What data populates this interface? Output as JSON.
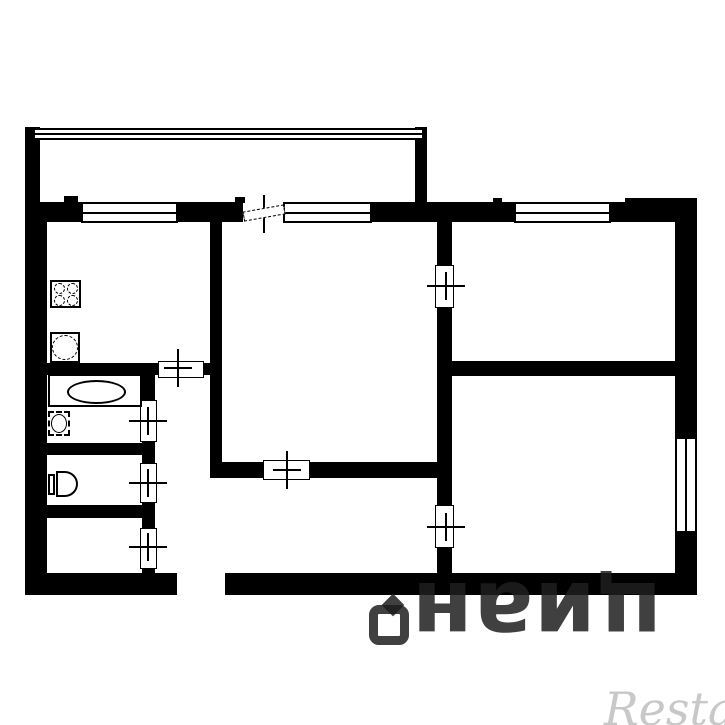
{
  "meta": {
    "background_color": "#ffffff",
    "wall_color": "#000000",
    "drawing_type": "apartment-floor-plan"
  },
  "watermarks": {
    "cian": {
      "text": "циан",
      "color": "rgba(30,30,30,0.85)",
      "rotation_deg": 180,
      "x": 412,
      "y": 540,
      "width": 250,
      "height": 105,
      "font_size": 88
    },
    "restate": {
      "text": "Restate",
      "color": "#c8c8c8",
      "x": 604,
      "y": 682,
      "font_size": 46
    }
  },
  "plan": {
    "walls": [
      {
        "name": "balcony-left-wall",
        "x": 25,
        "y": 127,
        "w": 15,
        "h": 76
      },
      {
        "name": "balcony-right-wall",
        "x": 415,
        "y": 127,
        "w": 12,
        "h": 78
      },
      {
        "name": "top-wall-left",
        "x": 25,
        "y": 202,
        "w": 56,
        "h": 20
      },
      {
        "name": "top-wall-mid-a",
        "x": 178,
        "y": 202,
        "w": 65,
        "h": 20
      },
      {
        "name": "top-wall-mid-b",
        "x": 372,
        "y": 202,
        "w": 142,
        "h": 20
      },
      {
        "name": "top-wall-right",
        "x": 611,
        "y": 202,
        "w": 86,
        "h": 20
      },
      {
        "name": "left-outer-wall",
        "x": 25,
        "y": 202,
        "w": 22,
        "h": 393
      },
      {
        "name": "right-outer-wall-upper",
        "x": 675,
        "y": 202,
        "w": 22,
        "h": 235
      },
      {
        "name": "right-outer-wall-lower",
        "x": 675,
        "y": 533,
        "w": 22,
        "h": 62
      },
      {
        "name": "bottom-wall-left",
        "x": 25,
        "y": 573,
        "w": 152,
        "h": 22
      },
      {
        "name": "bottom-wall-right",
        "x": 225,
        "y": 573,
        "w": 472,
        "h": 22
      },
      {
        "name": "livingroom-left-wall",
        "x": 210,
        "y": 222,
        "w": 12,
        "h": 256
      },
      {
        "name": "kitchen-bottom-wall",
        "x": 38,
        "y": 363,
        "w": 122,
        "h": 12
      },
      {
        "name": "kitchen-bottom-wall-b",
        "x": 202,
        "y": 363,
        "w": 20,
        "h": 12
      },
      {
        "name": "wc-column-wall-a",
        "x": 142,
        "y": 375,
        "w": 13,
        "h": 26
      },
      {
        "name": "wc-column-wall-b",
        "x": 142,
        "y": 441,
        "w": 13,
        "h": 23
      },
      {
        "name": "wc-column-wall-c",
        "x": 142,
        "y": 502,
        "w": 13,
        "h": 27
      },
      {
        "name": "wc-column-wall-d",
        "x": 142,
        "y": 568,
        "w": 13,
        "h": 10
      },
      {
        "name": "bath-toilet-divider",
        "x": 40,
        "y": 443,
        "w": 115,
        "h": 12
      },
      {
        "name": "toilet-closet-divider",
        "x": 40,
        "y": 505,
        "w": 115,
        "h": 13
      },
      {
        "name": "livingroom-bottom-wall-a",
        "x": 210,
        "y": 462,
        "w": 55,
        "h": 16
      },
      {
        "name": "livingroom-bottom-wall-b",
        "x": 308,
        "y": 462,
        "w": 144,
        "h": 16
      },
      {
        "name": "bedrooms-left-wall-a",
        "x": 437,
        "y": 222,
        "w": 15,
        "h": 44
      },
      {
        "name": "bedrooms-left-wall-b",
        "x": 437,
        "y": 307,
        "w": 15,
        "h": 199
      },
      {
        "name": "bedrooms-left-wall-c",
        "x": 437,
        "y": 547,
        "w": 15,
        "h": 32
      },
      {
        "name": "bedrooms-divider-wall",
        "x": 445,
        "y": 361,
        "w": 252,
        "h": 15
      },
      {
        "name": "wall-notch-a",
        "x": 64,
        "y": 196,
        "w": 14,
        "h": 7
      },
      {
        "name": "wall-notch-b",
        "x": 235,
        "y": 197,
        "w": 10,
        "h": 6
      },
      {
        "name": "wall-notch-c",
        "x": 493,
        "y": 198,
        "w": 9,
        "h": 5
      },
      {
        "name": "wall-notch-d",
        "x": 625,
        "y": 198,
        "w": 72,
        "h": 5
      }
    ],
    "railing": {
      "name": "balcony-railing",
      "x": 35,
      "y": 128,
      "w": 387,
      "h": 12
    },
    "windows": [
      {
        "name": "kitchen-window",
        "x": 81,
        "y": 202,
        "w": 97,
        "h": 21,
        "orientation": "h"
      },
      {
        "name": "livingroom-window",
        "x": 283,
        "y": 202,
        "w": 89,
        "h": 21,
        "orientation": "h"
      },
      {
        "name": "bedroom1-window",
        "x": 514,
        "y": 202,
        "w": 97,
        "h": 21,
        "orientation": "h"
      },
      {
        "name": "bedroom2-window",
        "x": 675,
        "y": 437,
        "w": 22,
        "h": 96,
        "orientation": "v"
      }
    ],
    "doors": [
      {
        "name": "kitchen-door",
        "x": 158,
        "y": 361,
        "w": 46,
        "h": 17
      },
      {
        "name": "livingroom-door",
        "x": 263,
        "y": 460,
        "w": 47,
        "h": 20
      },
      {
        "name": "bathroom-door",
        "x": 140,
        "y": 400,
        "w": 17,
        "h": 42
      },
      {
        "name": "toilet-door",
        "x": 140,
        "y": 463,
        "w": 17,
        "h": 40
      },
      {
        "name": "closet-door",
        "x": 140,
        "y": 528,
        "w": 17,
        "h": 41
      },
      {
        "name": "bedroom1-door",
        "x": 435,
        "y": 265,
        "w": 19,
        "h": 43
      },
      {
        "name": "bedroom2-door",
        "x": 435,
        "y": 505,
        "w": 19,
        "h": 43
      }
    ],
    "crosses": [
      {
        "name": "kitchen-door-cross",
        "cx": 178,
        "cy": 368,
        "long": "v"
      },
      {
        "name": "livingroom-door-cross",
        "cx": 287,
        "cy": 470,
        "long": "v"
      },
      {
        "name": "balcony-door-cross",
        "cx": 264,
        "cy": 214,
        "long": "v"
      },
      {
        "name": "bathroom-door-cross",
        "cx": 148,
        "cy": 421,
        "long": "h"
      },
      {
        "name": "toilet-door-cross",
        "cx": 148,
        "cy": 483,
        "long": "h"
      },
      {
        "name": "closet-door-cross",
        "cx": 148,
        "cy": 547,
        "long": "h"
      },
      {
        "name": "bedroom1-door-cross",
        "cx": 446,
        "cy": 286,
        "long": "h"
      },
      {
        "name": "bedroom2-door-cross",
        "cx": 446,
        "cy": 527,
        "long": "h"
      }
    ],
    "balcony_door_leaf": {
      "name": "balcony-door-leaf",
      "x": 243,
      "y": 208,
      "w": 42,
      "h": 10
    },
    "fixtures": {
      "stove": {
        "name": "stove-icon",
        "x": 50,
        "y": 280,
        "w": 31,
        "h": 28,
        "burners": 4
      },
      "sink": {
        "name": "kitchen-sink-icon",
        "x": 50,
        "y": 332,
        "w": 30,
        "h": 31
      },
      "bathtub": {
        "name": "bathtub-icon",
        "x": 48,
        "y": 374,
        "w": 94,
        "h": 33
      },
      "washbasin": {
        "name": "washbasin-icon",
        "x": 48,
        "y": 411,
        "w": 22,
        "h": 25
      },
      "toilet": {
        "name": "toilet-icon",
        "x": 48,
        "y": 471,
        "w": 31,
        "h": 27
      }
    }
  }
}
